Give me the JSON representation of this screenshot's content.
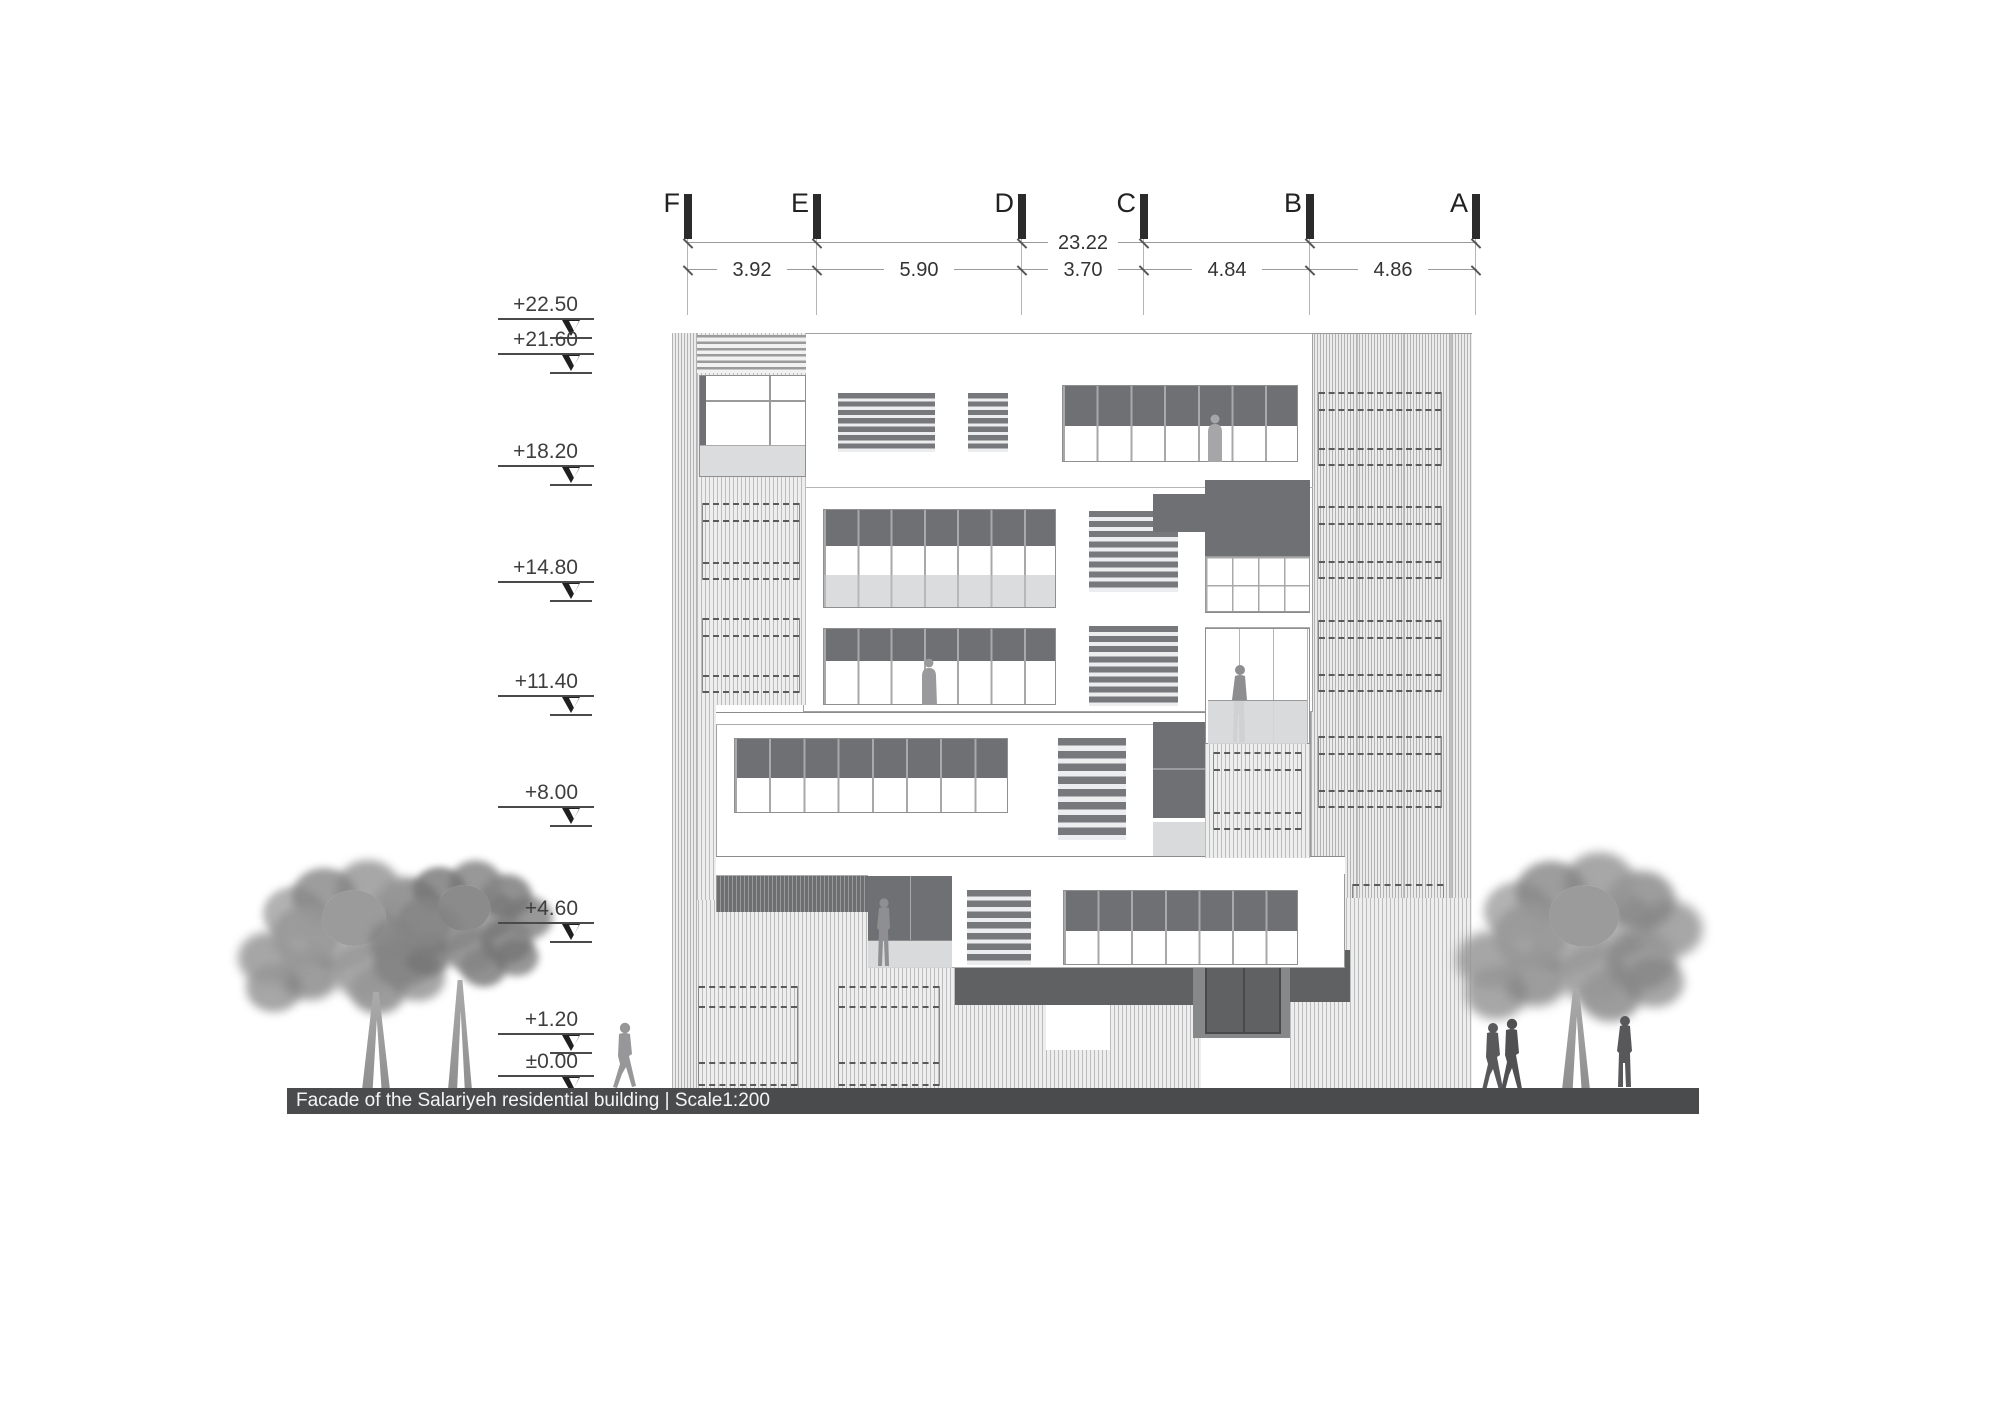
{
  "caption_bar": {
    "text": "Facade of the Salariyeh residential building | Scale1:200",
    "background": "#4a4b4d",
    "text_color": "#f5f5f5"
  },
  "grid_dimensions": {
    "overall": "23.22",
    "columns": [
      {
        "label": "F"
      },
      {
        "label": "E"
      },
      {
        "label": "D"
      },
      {
        "label": "C"
      },
      {
        "label": "B"
      },
      {
        "label": "A"
      }
    ],
    "segments": [
      {
        "label": "3.92"
      },
      {
        "label": "5.90"
      },
      {
        "label": "3.70"
      },
      {
        "label": "4.84"
      },
      {
        "label": "4.86"
      }
    ]
  },
  "levels": [
    {
      "label": "+22.50"
    },
    {
      "label": "+21.60"
    },
    {
      "label": "+18.20"
    },
    {
      "label": "+14.80"
    },
    {
      "label": "+11.40"
    },
    {
      "label": "+8.00"
    },
    {
      "label": "+4.60"
    },
    {
      "label": "+1.20"
    },
    {
      "label": "±0.00"
    }
  ],
  "colors": {
    "dark_panel": "#6f7073",
    "louver": "#77787b",
    "spandrel": "#dbdcde",
    "balcony_glass": "#d8d9db",
    "entry_recess": "#87888a",
    "ground_bar": "#4a4b4d",
    "foliage": "#9a9a9a",
    "grid_marker": "#2b2b2c"
  }
}
